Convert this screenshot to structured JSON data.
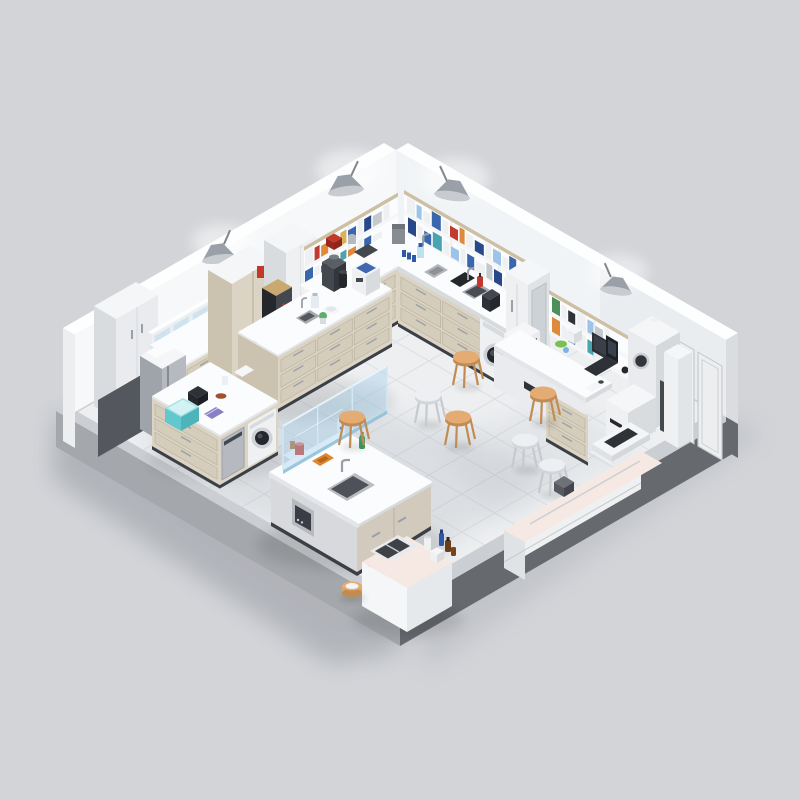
{
  "scene": {
    "type": "isometric-3d-render",
    "subject": "laboratory interior cutaway on a raised tiled platform",
    "view": "isometric from the south-west, two back walls visible",
    "objects": [
      "tiled-floor-platform",
      "dark-base-plinth",
      "left-back-wall",
      "right-back-wall",
      "wall-lamp x4",
      "corner-wall-shelves-with-binders",
      "desk-wall-shelf",
      "tall-white-cabinet",
      "glass-door-upper-cabinet",
      "tall-beige-cabinet-with-red-sign",
      "dark-bench-machine",
      "tall-white-column-cabinet",
      "stainless-steel-fridge",
      "l-shaped-wall-counter",
      "counter-clutter-bottles-hotplate-sink",
      "fire-extinguisher",
      "under-counter-washing-machine x2",
      "tall-white-lab-fridge",
      "built-in-oven",
      "back-left-island-with-analyzer",
      "left-island-with-washer",
      "teal-cooler-box",
      "center-island-with-glass-screen",
      "island-sink",
      "green-bottle",
      "red-beaker",
      "white-supply-cart-with-trays",
      "floor-basket",
      "computer-desk-with-laptop-and-monitor",
      "co2-incubator-with-port",
      "white-floor-machine",
      "right-wall-door-panels",
      "pink-side-bench",
      "bench-hood-device",
      "wooden-stool x4",
      "white-stool x3"
    ]
  },
  "palette": {
    "bg": "#d2d4d8",
    "bgShadow": "#84888f",
    "plinthL": "#a4a7ab",
    "plinthR": "#66696e",
    "apron": "#cbced2",
    "floor": "#edeff1",
    "tile": "#dcdfe2",
    "floorShade": "#a8aeb6",
    "wallL": "#f6f8f9",
    "wallR": "#f1f4f6",
    "cap": "#fdfefe",
    "wallEnd": "#eceef0",
    "wallOuter": "#dadcdf",
    "doorLine": "#c6c9cd",
    "darkPanel": "#54575d",
    "top": "#fbfcfd",
    "topEdge": "#e3e6e9",
    "topEdge2": "#d8dbde",
    "beige": "#dbd4c4",
    "beigeCell": "#d5cdbb",
    "beigeLine": "#bdb4a0",
    "beigeSide": "#cbc3af",
    "handle": "#9aa0a6",
    "kick": "#3c4046",
    "white": "#eef0f2",
    "whiteFace": "#e9ebee",
    "whiteSide": "#d9dcdf",
    "whiteTop": "#f4f6f7",
    "steel": "#b6bac0",
    "steelHi": "#ced2d7",
    "dark": "#2e3136",
    "dark2": "#43474e",
    "dark3": "#24272c",
    "glass": "#a8d2ec",
    "glassEdge": "#8fc0da",
    "glassDoor": "#cfe3ef",
    "wood": "#d9a76e",
    "woodHi": "#e4ab72",
    "woodDark": "#c08c54",
    "stoolWhite": "#edeff2",
    "stoolWhiteRim": "#d2d6da",
    "legWhite": "#c6cace",
    "lamp": "#9aa0a7",
    "lampDark": "#82878e",
    "lampLight": "#c8ccd1",
    "red": "#c4372b",
    "redDark": "#99291f",
    "orange": "#e0862f",
    "green": "#3f9e63",
    "greenDark": "#2e7348",
    "teal": "#62c8cd",
    "tealTop": "#9fe3e6",
    "tealDark": "#4db4ba",
    "purple": "#8a7fc7",
    "amber": "#6e3c14",
    "blue": "#2f58a8",
    "lightBlue": "#7ab4e4",
    "lime": "#7ac14f",
    "pinkTop": "#f6e9e3",
    "cream": "#cdbfa4",
    "tan": "#c9a96f"
  },
  "books": {
    "s1r1": [
      "#eef0f2",
      "#c23b2e",
      "#df8a3a",
      "#eef0f2",
      "#d9b05e",
      "#3a66ad",
      "#eef0f2",
      "#27498a",
      "#c5c9cd",
      "#eef0f2"
    ],
    "s1r2": [
      "#3a66ad",
      "#eef0f2",
      "#27498a",
      "#eef0f2",
      "#49a3b0",
      "#df8a3a",
      "#eef0f2",
      "#3a66ad",
      "#eef0f2"
    ],
    "s2r1": [
      "#eef0f2",
      "#9dc4e8",
      "#eef0f2",
      "#3a66ad",
      "#eef0f2",
      "#c23b2e",
      "#df8a3a",
      "#eef0f2",
      "#27498a",
      "#eef0f2",
      "#9dc4e8",
      "#eef0f2",
      "#3a66ad"
    ],
    "s2r2": [
      "#27498a",
      "#eef0f2",
      "#3a66ad",
      "#49a3b0",
      "#eef0f2",
      "#9dc4e8",
      "#eef0f2",
      "#3a66ad",
      "#eef0f2",
      "#c5c9cd",
      "#27498a",
      "#eef0f2"
    ],
    "s2r3": [
      "#3a66ad",
      "#eef0f2",
      "#27498a",
      "#9dc4e8",
      "#eef0f2",
      "#3a66ad",
      "#eef0f2"
    ],
    "s3r1": [
      "#4d8f5a",
      "#eef0f2",
      "#2f3338",
      "#eef0f2",
      "#9dc4e8",
      "#c5c9cd",
      "#eef0f2"
    ],
    "s3r2": [
      "#df8a3a",
      "#eef0f2",
      "#3a66ad",
      "#eef0f2",
      "#49a3b0",
      "#eef0f2",
      "#c23b2e"
    ]
  },
  "stools": {
    "wood": [
      [
        466,
        357
      ],
      [
        543,
        393
      ],
      [
        458,
        417
      ],
      [
        352,
        417
      ]
    ],
    "white": [
      [
        428,
        395
      ],
      [
        525,
        440
      ],
      [
        552,
        465
      ]
    ]
  }
}
